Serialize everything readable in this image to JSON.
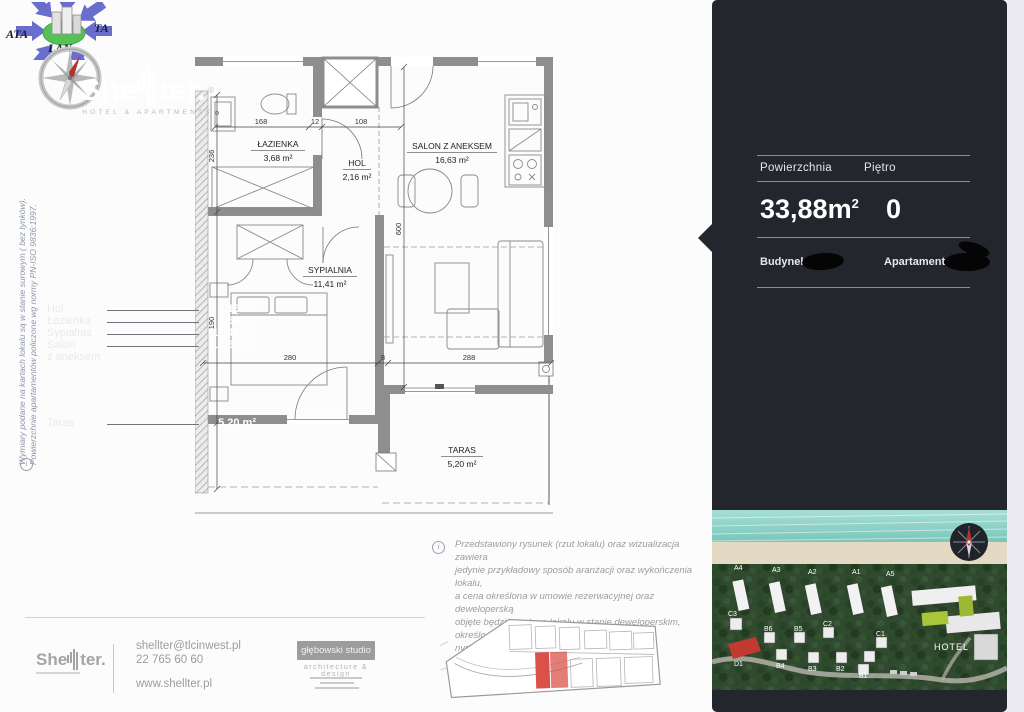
{
  "watermark": {
    "t1": "ATA",
    "t2": "TA",
    "t3": "LAN"
  },
  "side_note": {
    "line1": "Wymiary podane na  kartach lokalu są w stanie surowym ( bez tynków).",
    "line2": "Powierzchnie apartamentów policzone wg normy PN-ISO 9836:1997."
  },
  "floor_plan": {
    "rooms": [
      {
        "name": "ŁAZIENKA",
        "area": "3,68 m²"
      },
      {
        "name": "HOL",
        "area": "2,16 m²"
      },
      {
        "name": "SALON Z ANEKSEM",
        "area": "16,63 m²"
      },
      {
        "name": "SYPIALNIA",
        "area": "11,41 m²"
      },
      {
        "name": "TARAS",
        "area": "5,20 m²"
      }
    ],
    "dims": {
      "d168": "168",
      "d12": "12",
      "d108": "108",
      "d280": "280",
      "d8": "8",
      "d288": "288",
      "d236": "236",
      "d190": "190",
      "d600": "600"
    }
  },
  "panel": {
    "brand_left": "She",
    "brand_right": "ter.",
    "brand_reg": "®",
    "tagline": "HOTEL & APARTMENTS",
    "area_label": "Powierzchnia",
    "floor_label": "Piętro",
    "area_value": "33,88m",
    "area_sup": "2",
    "floor_value": "0",
    "building_label": "Budynek:",
    "apartment_label": "Apartament:",
    "room_rows": [
      {
        "label": "Hol",
        "value": "2,16 m²"
      },
      {
        "label": "Łazienka",
        "value": "3,68 m²"
      },
      {
        "label": "Sypialnia",
        "value": "11,41 m²"
      },
      {
        "label": "Salon",
        "value": "16,63 m²"
      }
    ],
    "salon_cont": "z aneksem",
    "taras_row": {
      "label": "Taras",
      "value": "5,20 m²"
    }
  },
  "site_photo": {
    "labels": [
      "A4",
      "A3",
      "A2",
      "A1",
      "A5",
      "C3",
      "B6",
      "B5",
      "C2",
      "C1",
      "D1",
      "B4",
      "B3",
      "B2",
      "B1"
    ],
    "hotel_label": "HOTEL"
  },
  "disclaimer": {
    "lines": [
      "Przedstawiony rysunek (rzut lokalu) oraz wizualizacja zawiera",
      "jedynie przykładowy sposób aranżacji oraz wykończenia lokalu,",
      "a  cena określona w umowie rezerwacyjnej oraz deweloperską",
      "objęte będzie wydane lokalu w stanie deweloperskim, określo-",
      "nym szczegółowe w prospekcie informacyjnym."
    ]
  },
  "footer": {
    "brand_left": "She",
    "brand_right": "ter.",
    "email": "shellter@tlcinwest.pl",
    "phone": "22 765 60 60",
    "web": "www.shellter.pl",
    "studio": "głębowski studio",
    "studio_sub": "architecture  &  design"
  },
  "colors": {
    "panel": "#24262d",
    "accent_red": "#d95149",
    "wall_gray": "#8e8e8e"
  }
}
